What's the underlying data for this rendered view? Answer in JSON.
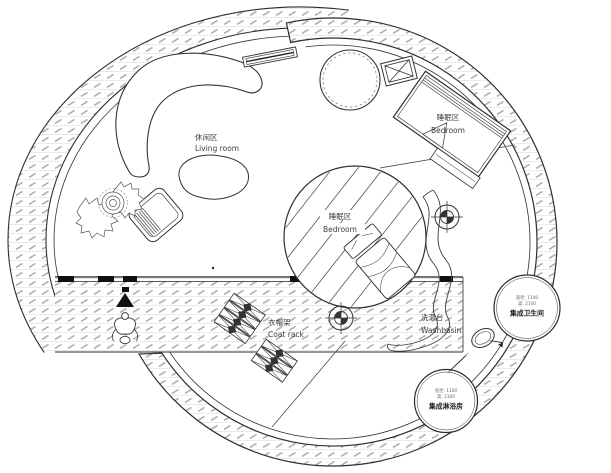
{
  "plan": {
    "labels": {
      "living": {
        "zh": "休闲区",
        "en": "Living room"
      },
      "bedroom_top": {
        "zh": "睡眠区",
        "en": "Bedroom"
      },
      "bedroom_center": {
        "zh": "睡眠区",
        "en": "Bedroom"
      },
      "coat_rack": {
        "zh": "衣帽架",
        "en": "Coat rack"
      },
      "washbasin": {
        "zh": "洗漱台",
        "en": "Washbasin"
      },
      "bathroom": {
        "dim1": "直径: 1100",
        "dim2": "高: 2100",
        "name": "集成卫生间"
      },
      "shower": {
        "dim1": "直径: 1100",
        "dim2": "高: 2100",
        "name": "集成淋浴房"
      }
    },
    "colors": {
      "line": "#2e2e2e",
      "hatch_dash": "#b0b0b0",
      "hatch_course": "#e2e2e2",
      "text": "#3d3d3d"
    }
  }
}
